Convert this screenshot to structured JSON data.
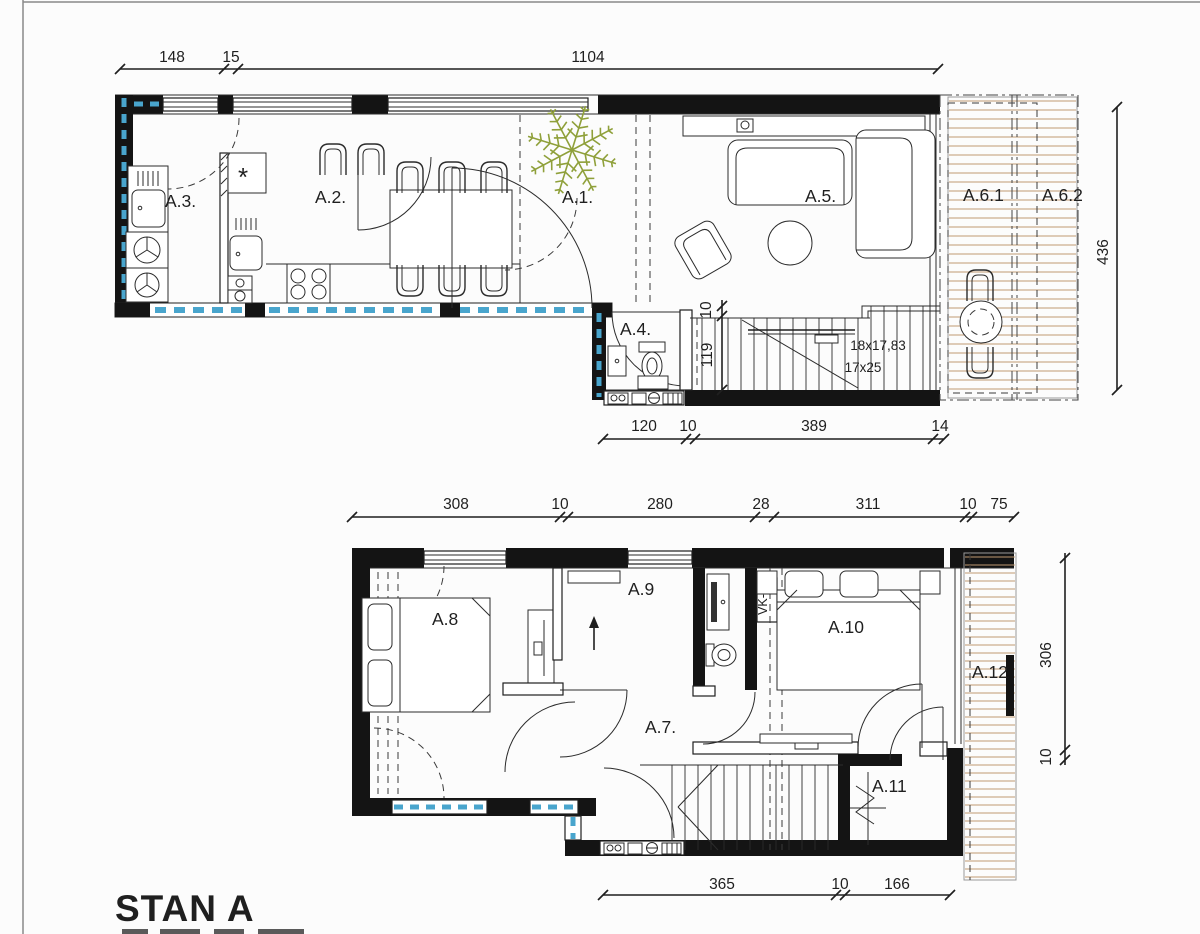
{
  "title": "STAN A",
  "labels": {
    "a1": "A.1.",
    "a2": "A.2.",
    "a3": "A.3.",
    "a4": "A.4.",
    "a5": "A.5.",
    "a61": "A.6.1",
    "a62": "A.6.2",
    "a7": "A.7.",
    "a8": "A.8",
    "a9": "A.9",
    "a10": "A.10",
    "a11": "A.11",
    "a12": "A.12",
    "vk5": "VK-5",
    "stair_note1": "18x17,83",
    "stair_note2": "17x25"
  },
  "dims": {
    "u_top": [
      "148",
      "15",
      "1104"
    ],
    "u_bottom": [
      "120",
      "10",
      "389",
      "14"
    ],
    "u_right": "436",
    "u_stair": [
      "10",
      "119"
    ],
    "l_top": [
      "308",
      "10",
      "280",
      "28",
      "311",
      "10",
      "75"
    ],
    "l_bottom": [
      "365",
      "10",
      "166"
    ],
    "l_right": [
      "306",
      "10"
    ]
  },
  "colors": {
    "wall": "#141414",
    "glass_blue": "#49a5cd",
    "deck_lines": "#c19a72",
    "plant_green": "#8fa03a",
    "drawing_line": "#2b2b2b"
  }
}
